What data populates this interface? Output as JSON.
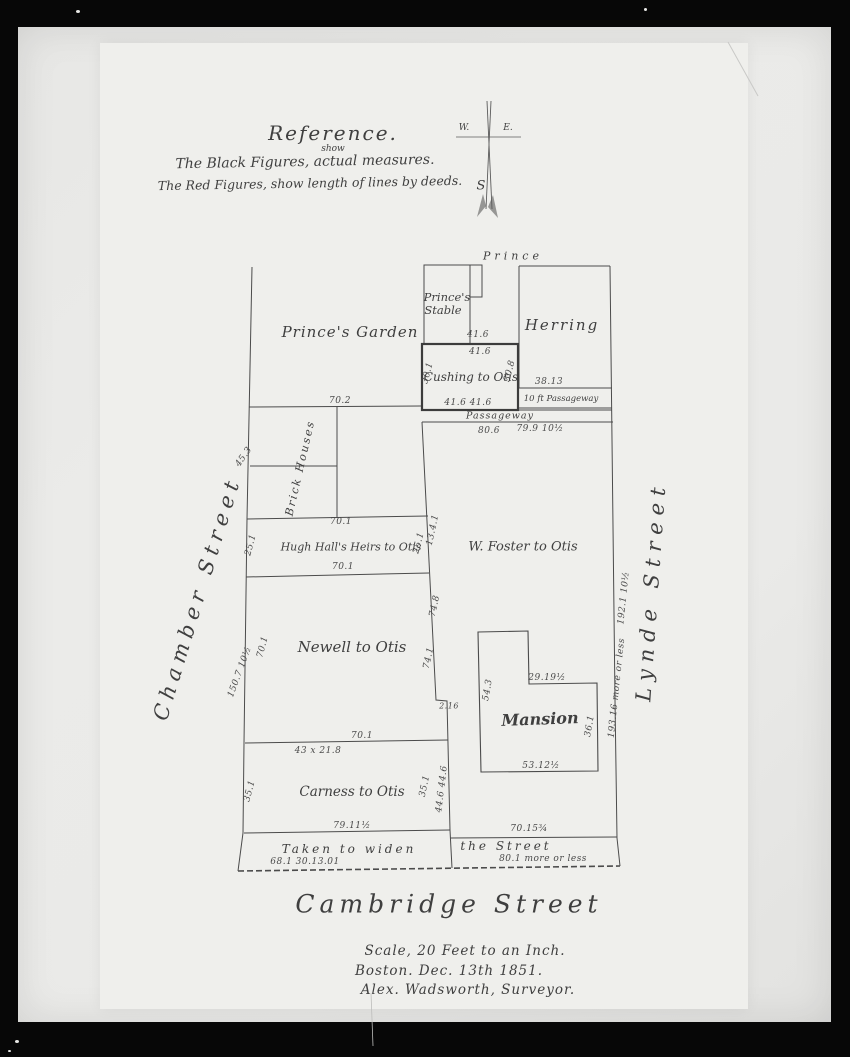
{
  "photo": {
    "frame_color": "#070707",
    "print_color": "#eaeae8",
    "paper_color": "#efefec",
    "ink_color": "#474747"
  },
  "reference": {
    "title": "Reference.",
    "inserted_word": "show",
    "line1": "The Black Figures, actual measures.",
    "line2": "The Red Figures, show length of lines by deeds."
  },
  "compass": {
    "west": "W.",
    "east": "E.",
    "south": "S"
  },
  "streets": {
    "prince": "Prince",
    "chamber": "Chamber Street",
    "lynde": "Lynde Street",
    "cambridge": "Cambridge Street"
  },
  "parcels": {
    "garden": "Prince's Garden",
    "stable_line1": "Prince's",
    "stable_line2": "Stable",
    "herring": "Herring",
    "cushing": "Cushing to Otis",
    "passageway10": "10 ft Passageway",
    "passageway": "Passageway",
    "foster": "W. Foster to Otis",
    "hugh_hall": "Hugh Hall's Heirs to Otis",
    "newell": "Newell to Otis",
    "mansion": "Mansion",
    "carness": "Carness to Otis",
    "brick_houses": "Brick Houses",
    "taken_line1": "Taken to widen",
    "taken_line2": "the Street"
  },
  "measures": {
    "garden_line": "70.2",
    "cushing_top_black": "41.6",
    "cushing_top_red": "41.6",
    "cushing_left": "30.1",
    "cushing_right": "30.8",
    "cushing_bottom": "41.6   41.6",
    "herring_bottom": "38.13",
    "foster_top_black": "80.6",
    "foster_top_red": "79.9 10½",
    "brick_diagonal": "45.3",
    "hugh_top": "70.1",
    "hugh_bottom": "70.1",
    "hugh_left": "25.1",
    "hugh_right": "25.1",
    "foster_left": "13.4.1",
    "newell_left": "70.1",
    "newell_right_black": "74.8",
    "newell_right_red": "74.1",
    "newell_bottom": "70.1",
    "newell_jog": "2.16",
    "chamber_length": "150.7 10½",
    "carness_top": "43 x 21.8",
    "carness_left": "35.1",
    "carness_right": "35.1",
    "carness_lynde": "44.6  44.6",
    "carness_bottom": "79.11½",
    "foster_bottom": "70.15¾",
    "taken_left_figures": "68.1   30.13.01",
    "taken_right_figures": "80.1 more or less",
    "mansion_notch": "29.19½",
    "mansion_left": "54.3",
    "mansion_right": "36.1",
    "mansion_bottom": "53.12½",
    "lynde_red": "192.1 10½",
    "lynde_black": "193.16 more or less"
  },
  "footer": {
    "scale": "Scale, 20 Feet to an Inch.",
    "dateline": "Boston. Dec. 13th 1851.",
    "surveyor": "Alex. Wadsworth, Surveyor."
  }
}
